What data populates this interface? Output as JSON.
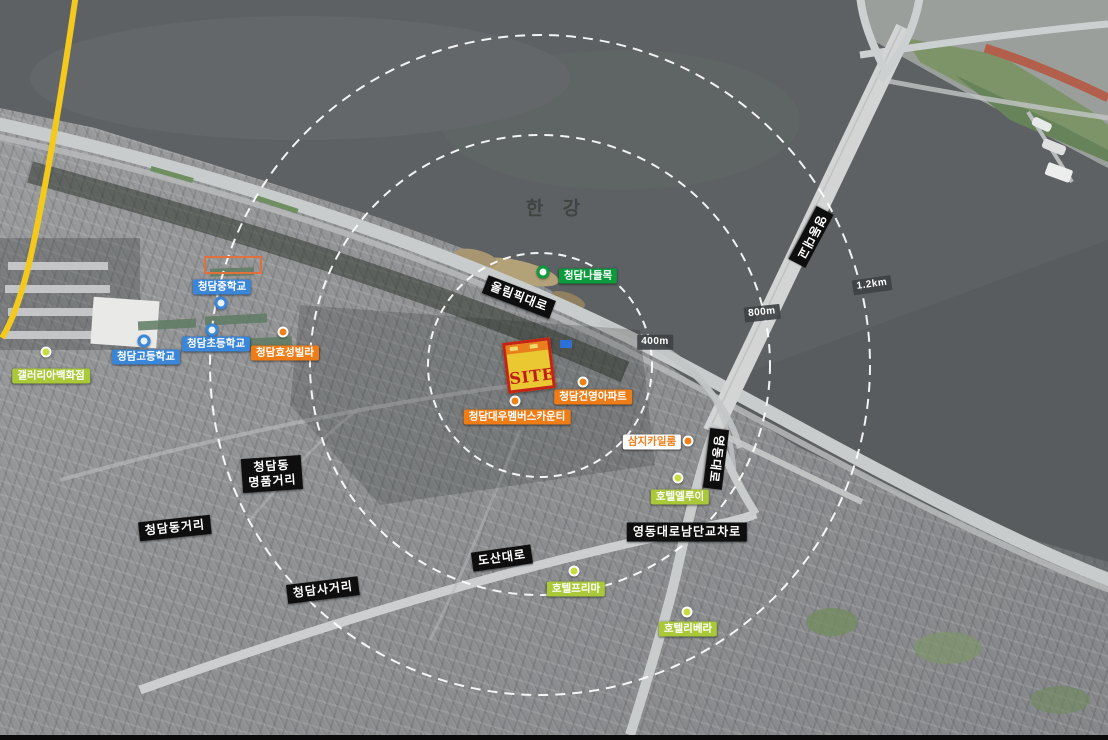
{
  "map": {
    "river_label": "한 강",
    "site_marker_label": "SITE",
    "distance_rings": [
      {
        "label": "400m"
      },
      {
        "label": "800m"
      },
      {
        "label": "1.2km"
      }
    ],
    "roads": {
      "olympic_daero": "올림픽대로",
      "yeongdong_bridge": "영동대교",
      "yeongdong_daero": "영동대로",
      "dosan_daero": "도산대로",
      "yeongdong_daero_south_junction": "영동대로남단교차로",
      "cheongdam_sageori": "청담사거리",
      "cheongdamdong_geori": "청담동거리",
      "luxury_street_line1": "청담동",
      "luxury_street_line2": "명품거리",
      "cheongdam_interchange": "청담나들목"
    },
    "schools": [
      {
        "label": "청담중학교"
      },
      {
        "label": "청담초등학교"
      },
      {
        "label": "청담고등학교"
      }
    ],
    "landmarks": [
      {
        "label": "갤러리아백화점"
      },
      {
        "label": "청담효성빌라"
      },
      {
        "label": "청담건영아파트"
      },
      {
        "label": "청담대우멤버스카운티"
      },
      {
        "label": "삼지카일룸"
      }
    ],
    "hotels": [
      {
        "label": "호텔엘루이"
      },
      {
        "label": "호텔프리마"
      },
      {
        "label": "호텔리베라"
      }
    ],
    "colors": {
      "river": "#5d6163",
      "school_blue": "#3a86d8",
      "orange": "#ee7d18",
      "green": "#0a9b3d",
      "lime": "#a9c938",
      "road_label_black": "#0e0e0e",
      "site_yellow": "#e9c832",
      "site_red": "#c42318",
      "boundary_yellow": "#f3c91e",
      "ring_dash_white": "#ffffff"
    }
  }
}
